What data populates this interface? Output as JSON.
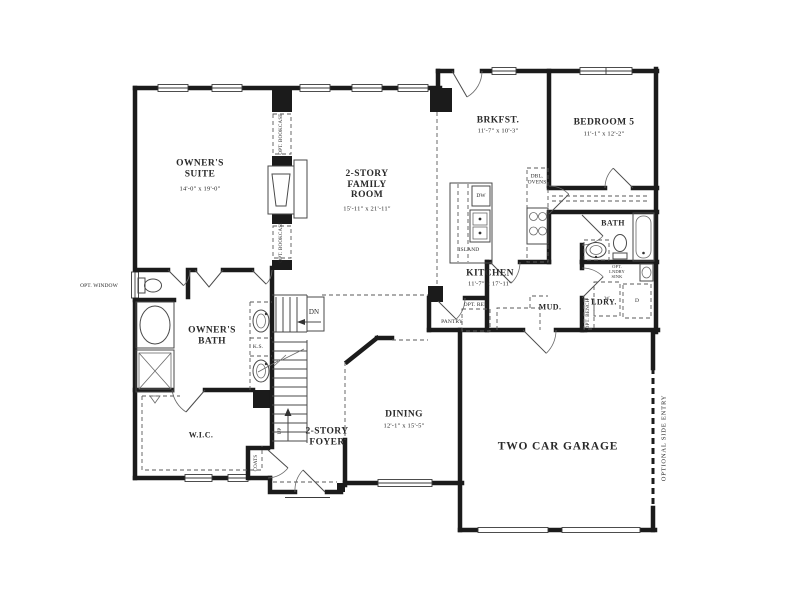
{
  "rooms": {
    "owners_suite": {
      "name": "OWNER'S\nSUITE",
      "dims": "14'-0\" x 19'-0\""
    },
    "family": {
      "name": "2-STORY\nFAMILY\nROOM",
      "dims": "15'-11\" x 21'-11\""
    },
    "brkfst": {
      "name": "BRKFST.",
      "dims": "11'-7\" x 10'-3\""
    },
    "bedroom5": {
      "name": "BEDROOM 5",
      "dims": "11'-1\" x 12'-2\""
    },
    "kitchen": {
      "name": "KITCHEN",
      "dims": "11'-7\" x 17'-11\""
    },
    "dining": {
      "name": "DINING",
      "dims": "12'-1\" x 15'-5\""
    },
    "garage": {
      "name": "TWO CAR GARAGE"
    },
    "foyer": {
      "name": "2-STORY\nFOYER"
    },
    "owners_bath": {
      "name": "OWNER'S\nBATH"
    },
    "wic": {
      "name": "W.I.C."
    },
    "bath": {
      "name": "BATH"
    },
    "mud": {
      "name": "MUD."
    },
    "ldry": {
      "name": "LDRY."
    }
  },
  "annotations": {
    "opt_window": "OPT. WINDOW",
    "opt_bookcase": "OPT. BOOKCASE",
    "dbl_ovens": "DBL.\nOVENS",
    "dw": "DW",
    "island": "ISLAND",
    "pantry": "PANTRY",
    "opt_ref": "OPT. REF.",
    "coats": "COATS",
    "ks": "K.S.",
    "dn": "DN",
    "up": "UP",
    "opt_bench": "OPT. BENCH",
    "opt_lndry_sink": "OPT.\nLNDRY\nSINK",
    "washer": "W",
    "dryer": "D",
    "side_entry": "OPTIONAL SIDE ENTRY"
  },
  "colors": {
    "wall": "#1b1b1b",
    "text": "#2a2a2a",
    "background": "#ffffff",
    "thin_line": "#4a4a4a"
  }
}
